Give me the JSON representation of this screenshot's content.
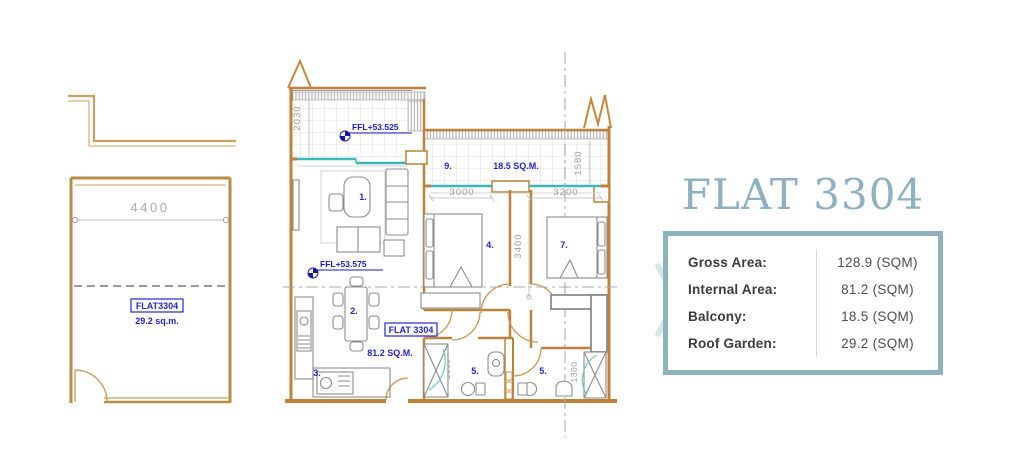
{
  "left_plan": {
    "width_dim": "4400",
    "flat_label": "FLAT3304",
    "area_label": "29.2 sq.m."
  },
  "main_plan": {
    "ffl_balcony": "FFL+53.525",
    "ffl_living": "FFL+53.575",
    "flat_label": "FLAT 3304",
    "internal_area": "81.2 SQ.M.",
    "balcony_area": "18.5 SQ.M.",
    "room_numbers": {
      "living": "1.",
      "dining": "2.",
      "kitchen": "3.",
      "bedroom1": "4.",
      "bath1": "5.",
      "bath2": "5.",
      "bedroom2": "7.",
      "balcony": "9."
    },
    "dimensions": {
      "balcony_depth": "2030",
      "terrace_depth": "1580",
      "bedroom1_width": "3000",
      "bedroom1_depth": "3200",
      "bedroom2_width": "3200",
      "hall_depth": "3400",
      "bath1_width": "1600",
      "bath2_width": "1300"
    }
  },
  "info_panel": {
    "title": "FLAT 3304",
    "rows": [
      {
        "label": "Gross Area:",
        "value": "128.9 (SQM)"
      },
      {
        "label": "Internal Area:",
        "value": "81.2 (SQM)"
      },
      {
        "label": "Balcony:",
        "value": "18.5 (SQM)"
      },
      {
        "label": "Roof Garden:",
        "value": "29.2 (SQM)"
      }
    ]
  },
  "colors": {
    "wall": "#bf8238",
    "wall_light": "#c9a161",
    "window_teal": "#3cb7b9",
    "annotation_blue": "#2424d0",
    "dimension_gray": "#9e9e9e",
    "furniture_gray": "#8c8c8c",
    "accent": "#8fb3bd",
    "title": "#8eb1c1"
  }
}
